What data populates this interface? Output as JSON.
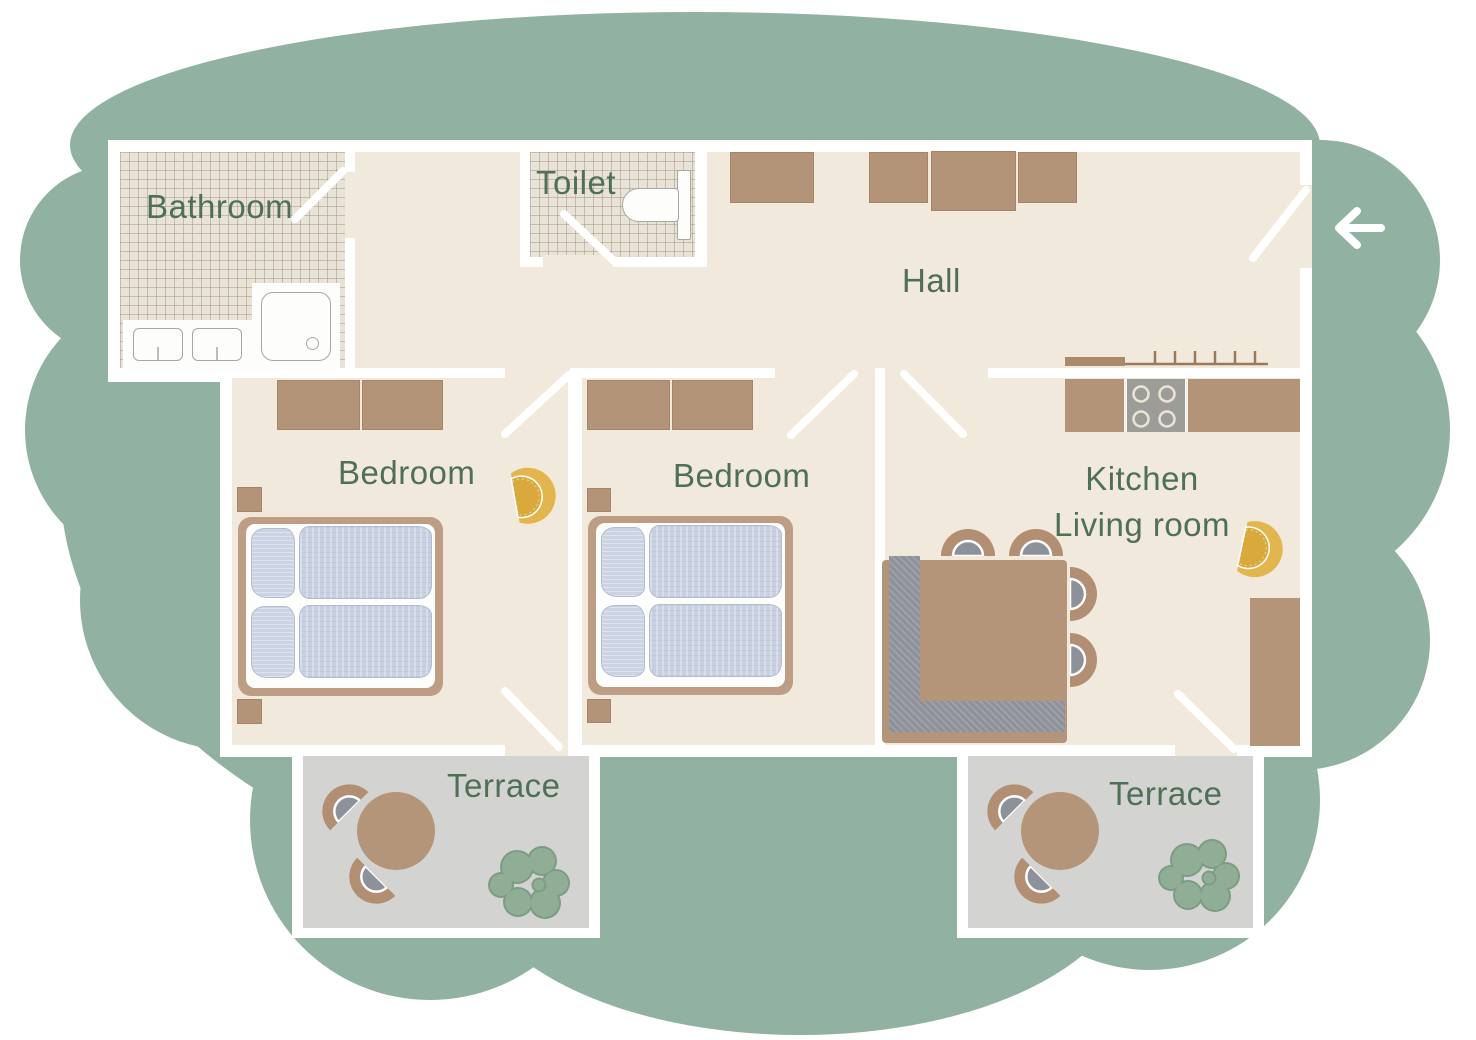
{
  "rooms": {
    "bathroom": {
      "label": "Bathroom"
    },
    "toilet": {
      "label": "Toilet"
    },
    "hall": {
      "label": "Hall"
    },
    "bedroom_left": {
      "label": "Bedroom"
    },
    "bedroom_middle": {
      "label": "Bedroom"
    },
    "kitchen_living": {
      "label_line1": "Kitchen",
      "label_line2": "Living room"
    },
    "terrace_left": {
      "label": "Terrace"
    },
    "terrace_right": {
      "label": "Terrace"
    }
  },
  "icons": {
    "entrance": "arrow-left-icon",
    "lamps": [
      "ceiling-lamp-icon (bedroom left)",
      "ceiling-lamp-icon (kitchen)"
    ],
    "furniture": [
      "double-bed",
      "wardrobe",
      "nightstand",
      "corner-sofa",
      "dining-table",
      "chair",
      "kitchen-counter",
      "stove",
      "coat-rack",
      "sideboard",
      "round-table",
      "plant",
      "toilet",
      "sink",
      "shower"
    ]
  },
  "palette": {
    "background_blob": "#91b1a1",
    "wall": "#ffffff",
    "floor_cream": "#f1e9dc",
    "floor_tile": "#e9e2d6",
    "terrace_gray": "#d3d4d1",
    "furniture_tan": "#b49579",
    "bed_frame": "#bd9d84",
    "textile_blue": "#c9d1e1",
    "sofa_gray": "#8d9199",
    "lamp_yellow": "#e2b54d",
    "plant_green": "#8fae95",
    "label_green": "#4f7057"
  }
}
